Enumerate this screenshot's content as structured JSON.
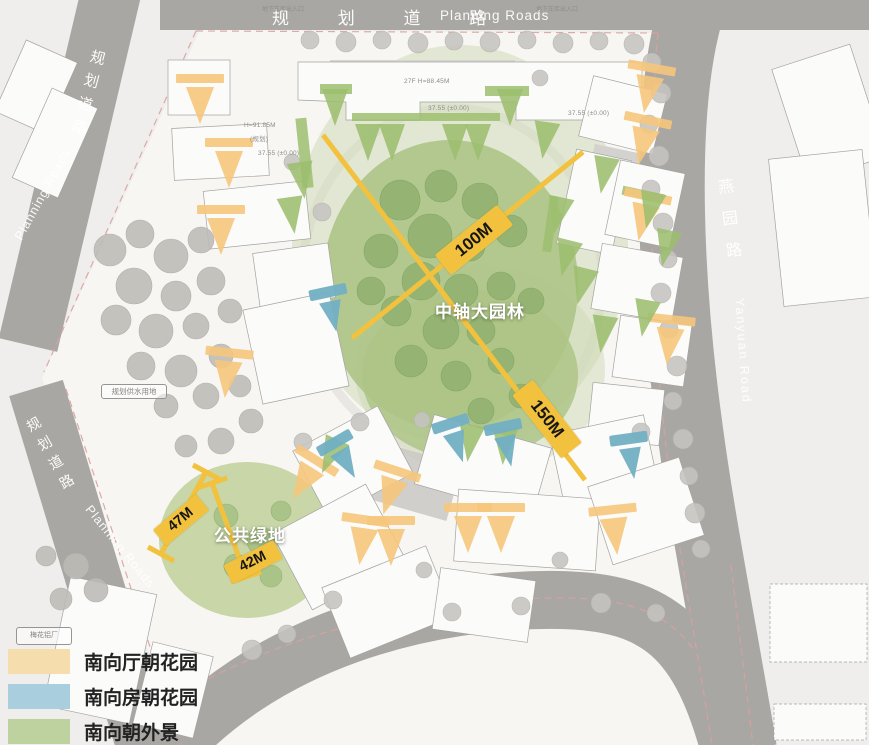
{
  "map": {
    "roads": {
      "top": {
        "zh": "规 划 道 路",
        "en": "Planning Roads"
      },
      "left_upper": {
        "zh": "规划道路",
        "en": "Planning Roads"
      },
      "left_lower": {
        "zh": "规划道路",
        "en": "Planning Roads"
      },
      "right": {
        "zh": "燕园路",
        "en": "Yanyuan Road"
      }
    },
    "labels": {
      "central_garden": "中轴大园林",
      "public_green": "公共绿地"
    },
    "measurements": {
      "m100": "100M",
      "m150": "150M",
      "m47": "47M",
      "m42": "42M"
    },
    "small_boxes": {
      "plant": "梅花铝厂",
      "water": "规划供水用地"
    },
    "entrance_note": "地下车库出入口",
    "annotations": [
      "27F H=88.45M",
      "37.55 (±0.00)",
      "H=91.85M",
      "(规划)"
    ]
  },
  "legend": {
    "items": [
      {
        "label": "南向厅朝花园",
        "color": "#f6ddad"
      },
      {
        "label": "南向房朝花园",
        "color": "#a9cedd"
      },
      {
        "label": "南向朝外景",
        "color": "#bdd29e"
      }
    ]
  },
  "colors": {
    "dimension_yellow": "#f2c13d",
    "garden_green": "#aec487",
    "road_gray": "#a9a7a4",
    "orange_marker": "#f6c77c",
    "blue_marker": "#72b0c4",
    "green_marker": "#9cbe6e"
  }
}
